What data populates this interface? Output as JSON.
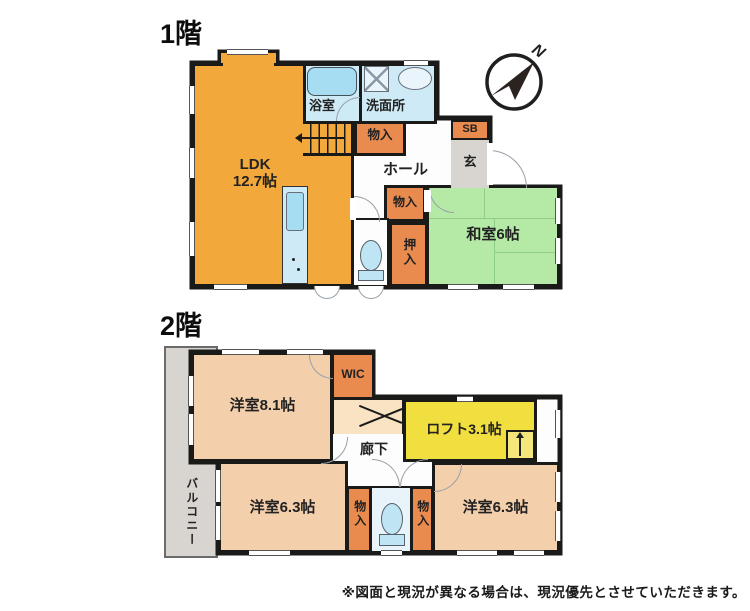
{
  "floor1": {
    "title": "1階",
    "rooms": {
      "ldk_label": "LDK",
      "ldk_size": "12.7帖",
      "bathroom": "浴室",
      "washroom": "洗面所",
      "closet_upper": "物入",
      "hall": "ホール",
      "shoe_box": "SB",
      "entrance": "玄",
      "closet_middle": "物入",
      "oshiire": "押入",
      "japanese_room": "和室6帖"
    },
    "compass": {
      "north_label": "N"
    }
  },
  "floor2": {
    "title": "2階",
    "rooms": {
      "bedroom_large": "洋室8.1帖",
      "wic": "WIC",
      "corridor": "廊下",
      "loft": "ロフト3.1帖",
      "balcony": "バルコニー",
      "bedroom_left": "洋室6.3帖",
      "closet_left": "物入",
      "closet_right": "物入",
      "bedroom_right": "洋室6.3帖"
    }
  },
  "footer": {
    "disclaimer": "※図面と現況が異なる場合は、現況優先とさせていただきます。"
  },
  "colors": {
    "ldk": "#F2A83B",
    "closet": "#E98B4E",
    "tatami": "#B5E9A6",
    "water": "#CEEAF6",
    "bedroom": "#F4CFAC",
    "loft": "#F1DE3F",
    "gray": "#D8D5D0",
    "wall": "#1A1A18"
  }
}
